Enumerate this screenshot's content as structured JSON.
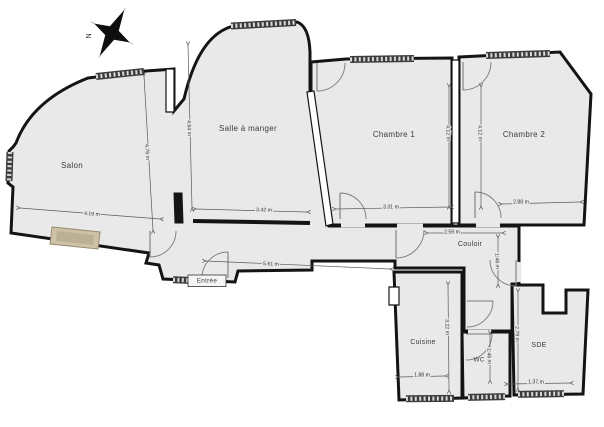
{
  "plan": {
    "compass": {
      "label": "N"
    },
    "colors": {
      "floor": "#e9e9e9",
      "wall": "#141414",
      "dimension": "#5a5a5a",
      "fireplace": "#cdc2a8"
    },
    "rooms": [
      {
        "id": "salon",
        "label": "Salon",
        "x": 72,
        "y": 166,
        "size": 8
      },
      {
        "id": "salle-a-manger",
        "label": "Salle à manger",
        "x": 248,
        "y": 129,
        "size": 8
      },
      {
        "id": "chambre-1",
        "label": "Chambre 1",
        "x": 394,
        "y": 135,
        "size": 8
      },
      {
        "id": "chambre-2",
        "label": "Chambre 2",
        "x": 524,
        "y": 135,
        "size": 8
      },
      {
        "id": "couloir",
        "label": "Couloir",
        "x": 470,
        "y": 244,
        "size": 7
      },
      {
        "id": "entree",
        "label": "Entrée",
        "x": 207,
        "y": 281,
        "size": 6.3
      },
      {
        "id": "cuisine",
        "label": "Cuisine",
        "x": 423,
        "y": 342,
        "size": 7
      },
      {
        "id": "wc",
        "label": "WC",
        "x": 479,
        "y": 360,
        "size": 6.3
      },
      {
        "id": "sde",
        "label": "SDE",
        "x": 539,
        "y": 345,
        "size": 7
      }
    ],
    "dimensions": [
      {
        "label": "4.19 m",
        "x1": 20,
        "y1": 208,
        "x2": 160,
        "y2": 219,
        "tx": 92,
        "ty": 214,
        "rot": 4
      },
      {
        "label": "4.76 m",
        "x1": 144,
        "y1": 76,
        "x2": 153,
        "y2": 230,
        "tx": 147,
        "ty": 152,
        "rot": 87
      },
      {
        "label": "4.64 m",
        "x1": 188,
        "y1": 45,
        "x2": 192,
        "y2": 208,
        "tx": 189,
        "ty": 128,
        "rot": 89
      },
      {
        "label": "3.42 m",
        "x1": 196,
        "y1": 209,
        "x2": 307,
        "y2": 212,
        "tx": 264,
        "ty": 210,
        "rot": 1
      },
      {
        "label": "4.12 m",
        "x1": 449,
        "y1": 87,
        "x2": 449,
        "y2": 206,
        "tx": 448,
        "ty": 133,
        "rot": 89
      },
      {
        "label": "3.31 m",
        "x1": 336,
        "y1": 209,
        "x2": 450,
        "y2": 207,
        "tx": 391,
        "ty": 207,
        "rot": 0
      },
      {
        "label": "4.12 m",
        "x1": 481,
        "y1": 87,
        "x2": 481,
        "y2": 206,
        "tx": 480,
        "ty": 133,
        "rot": 89
      },
      {
        "label": "2.88 m",
        "x1": 502,
        "y1": 204,
        "x2": 580,
        "y2": 202,
        "tx": 521,
        "ty": 202,
        "rot": 0
      },
      {
        "label": "2.59 m",
        "x1": 428,
        "y1": 233,
        "x2": 502,
        "y2": 233,
        "tx": 452,
        "ty": 232,
        "rot": 0
      },
      {
        "label": "5.61 m",
        "x1": 206,
        "y1": 261,
        "x2": 390,
        "y2": 269,
        "tx": 271,
        "ty": 264,
        "rot": 2
      },
      {
        "label": "1.46 m",
        "x1": 498,
        "y1": 238,
        "x2": 498,
        "y2": 284,
        "tx": 497,
        "ty": 261,
        "rot": 88
      },
      {
        "label": "3.22 m",
        "x1": 448,
        "y1": 285,
        "x2": 449,
        "y2": 390,
        "tx": 447,
        "ty": 327,
        "rot": 89
      },
      {
        "label": "1.88 m",
        "x1": 399,
        "y1": 377,
        "x2": 445,
        "y2": 376,
        "tx": 422,
        "ty": 375,
        "rot": 0
      },
      {
        "label": "1.46 m",
        "x1": 490,
        "y1": 334,
        "x2": 490,
        "y2": 380,
        "tx": 489,
        "ty": 356,
        "rot": 88
      },
      {
        "label": "2.79 m",
        "x1": 518,
        "y1": 292,
        "x2": 518,
        "y2": 388,
        "tx": 517,
        "ty": 334,
        "rot": 88
      },
      {
        "label": "1.37 m",
        "x1": 508,
        "y1": 384,
        "x2": 570,
        "y2": 383,
        "tx": 536,
        "ty": 382,
        "rot": 0
      }
    ]
  }
}
